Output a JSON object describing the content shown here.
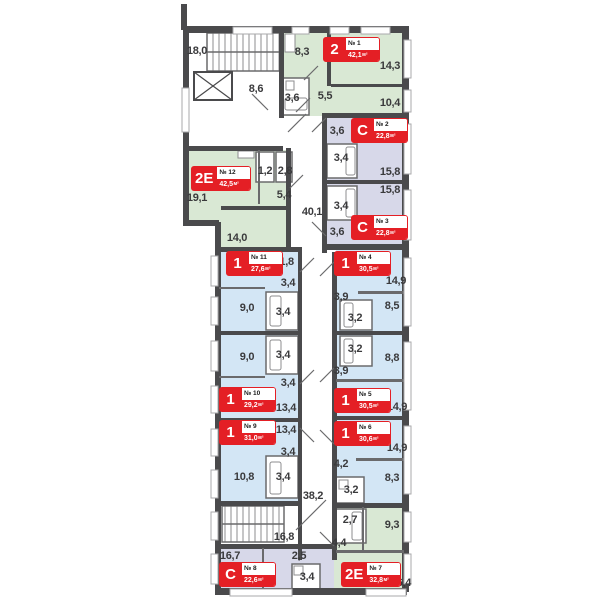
{
  "meta": {
    "area_unit": "м²"
  },
  "palette": {
    "wall": "#4a4a4c",
    "wallthin": "#6a6a6c",
    "winb": "#a9a9ab",
    "red": "#e41f25",
    "type1": "#d3e6f5",
    "type2": "#d9e8d4",
    "typeC": "#d7d8e9",
    "text": "#3a3a3c"
  },
  "apartments": [
    {
      "id": 1,
      "type": "2",
      "number": "№ 1",
      "area": "42,1",
      "color_key": "type2",
      "badge": {
        "x": 323,
        "y": 37
      },
      "rooms": [
        {
          "v": "8,3",
          "x": 302,
          "y": 52
        },
        {
          "v": "14,3",
          "x": 390,
          "y": 66
        },
        {
          "v": "10,4",
          "x": 390,
          "y": 103
        },
        {
          "v": "5,5",
          "x": 325,
          "y": 96
        },
        {
          "v": "3,6",
          "x": 292,
          "y": 98
        }
      ]
    },
    {
      "id": 2,
      "type": "С",
      "number": "№ 2",
      "area": "22,8",
      "color_key": "typeC",
      "badge": {
        "x": 351,
        "y": 118
      },
      "rooms": [
        {
          "v": "3,6",
          "x": 337,
          "y": 131
        },
        {
          "v": "3,4",
          "x": 341,
          "y": 158
        },
        {
          "v": "15,8",
          "x": 390,
          "y": 172
        }
      ]
    },
    {
      "id": 3,
      "type": "С",
      "number": "№ 3",
      "area": "22,8",
      "color_key": "typeC",
      "badge": {
        "x": 351,
        "y": 215
      },
      "rooms": [
        {
          "v": "15,8",
          "x": 390,
          "y": 190
        },
        {
          "v": "3,4",
          "x": 341,
          "y": 206
        },
        {
          "v": "3,6",
          "x": 337,
          "y": 232
        }
      ]
    },
    {
      "id": 4,
      "type": "1",
      "number": "№ 4",
      "area": "30,5",
      "color_key": "type1",
      "badge": {
        "x": 334,
        "y": 251
      },
      "rooms": [
        {
          "v": "14,9",
          "x": 396,
          "y": 281
        },
        {
          "v": "3,9",
          "x": 341,
          "y": 297
        },
        {
          "v": "8,5",
          "x": 392,
          "y": 306
        },
        {
          "v": "3,2",
          "x": 355,
          "y": 318
        }
      ]
    },
    {
      "id": 5,
      "type": "1",
      "number": "№ 5",
      "area": "30,5",
      "color_key": "type1",
      "badge": {
        "x": 334,
        "y": 388
      },
      "rooms": [
        {
          "v": "3,2",
          "x": 355,
          "y": 349
        },
        {
          "v": "8,8",
          "x": 392,
          "y": 358
        },
        {
          "v": "3,9",
          "x": 341,
          "y": 371
        },
        {
          "v": "14,9",
          "x": 397,
          "y": 407
        }
      ]
    },
    {
      "id": 6,
      "type": "1",
      "number": "№ 6",
      "area": "30,6",
      "color_key": "type1",
      "badge": {
        "x": 334,
        "y": 421
      },
      "rooms": [
        {
          "v": "14,9",
          "x": 397,
          "y": 448
        },
        {
          "v": "4,2",
          "x": 341,
          "y": 464
        },
        {
          "v": "8,3",
          "x": 392,
          "y": 478
        },
        {
          "v": "3,2",
          "x": 351,
          "y": 490
        }
      ]
    },
    {
      "id": 7,
      "type": "2Е",
      "number": "№ 7",
      "area": "32,8",
      "color_key": "type2",
      "badge": {
        "x": 341,
        "y": 562
      },
      "rooms": [
        {
          "v": "2,7",
          "x": 350,
          "y": 520
        },
        {
          "v": "9,3",
          "x": 392,
          "y": 525
        },
        {
          "v": "4,4",
          "x": 339,
          "y": 543
        },
        {
          "v": "16,4",
          "x": 401,
          "y": 583
        }
      ]
    },
    {
      "id": 8,
      "type": "С",
      "number": "№ 8",
      "area": "22,6",
      "color_key": "typeC",
      "badge": {
        "x": 219,
        "y": 562
      },
      "rooms": [
        {
          "v": "16,7",
          "x": 230,
          "y": 556
        },
        {
          "v": "2,5",
          "x": 299,
          "y": 556
        },
        {
          "v": "3,4",
          "x": 307,
          "y": 577
        }
      ]
    },
    {
      "id": 9,
      "type": "1",
      "number": "№ 9",
      "area": "31,0",
      "color_key": "type1",
      "badge": {
        "x": 219,
        "y": 420
      },
      "rooms": [
        {
          "v": "13,4",
          "x": 286,
          "y": 430
        },
        {
          "v": "3,4",
          "x": 288,
          "y": 452
        },
        {
          "v": "10,8",
          "x": 244,
          "y": 477
        },
        {
          "v": "3,4",
          "x": 283,
          "y": 477
        }
      ]
    },
    {
      "id": 10,
      "type": "1",
      "number": "№ 10",
      "area": "29,2",
      "color_key": "type1",
      "badge": {
        "x": 219,
        "y": 387
      },
      "rooms": [
        {
          "v": "9,0",
          "x": 247,
          "y": 357
        },
        {
          "v": "3,4",
          "x": 283,
          "y": 355
        },
        {
          "v": "3,4",
          "x": 288,
          "y": 383
        },
        {
          "v": "13,4",
          "x": 286,
          "y": 408
        }
      ]
    },
    {
      "id": 11,
      "type": "1",
      "number": "№ 11",
      "area": "27,6",
      "color_key": "type1",
      "badge": {
        "x": 226,
        "y": 251
      },
      "rooms": [
        {
          "v": "11,8",
          "x": 284,
          "y": 262
        },
        {
          "v": "3,4",
          "x": 288,
          "y": 283
        },
        {
          "v": "9,0",
          "x": 247,
          "y": 308
        },
        {
          "v": "3,4",
          "x": 283,
          "y": 312
        }
      ]
    },
    {
      "id": 12,
      "type": "2Е",
      "number": "№ 12",
      "area": "42,5",
      "color_key": "type2",
      "badge": {
        "x": 191,
        "y": 166
      },
      "rooms": [
        {
          "v": "19,1",
          "x": 197,
          "y": 198
        },
        {
          "v": "1,2",
          "x": 265,
          "y": 171
        },
        {
          "v": "2,8",
          "x": 285,
          "y": 171
        },
        {
          "v": "5,4",
          "x": 284,
          "y": 195
        },
        {
          "v": "14,0",
          "x": 237,
          "y": 238
        }
      ]
    }
  ],
  "common_areas": [
    {
      "name": "stairs-top",
      "v": "18,0",
      "x": 197,
      "y": 51
    },
    {
      "name": "entrance-lobby",
      "v": "8,6",
      "x": 256,
      "y": 89
    },
    {
      "name": "corridor-upper",
      "v": "40,1",
      "x": 312,
      "y": 212
    },
    {
      "name": "corridor-lower",
      "v": "38,2",
      "x": 313,
      "y": 496
    },
    {
      "name": "stairs-bottom",
      "v": "16,8",
      "x": 284,
      "y": 537
    }
  ]
}
